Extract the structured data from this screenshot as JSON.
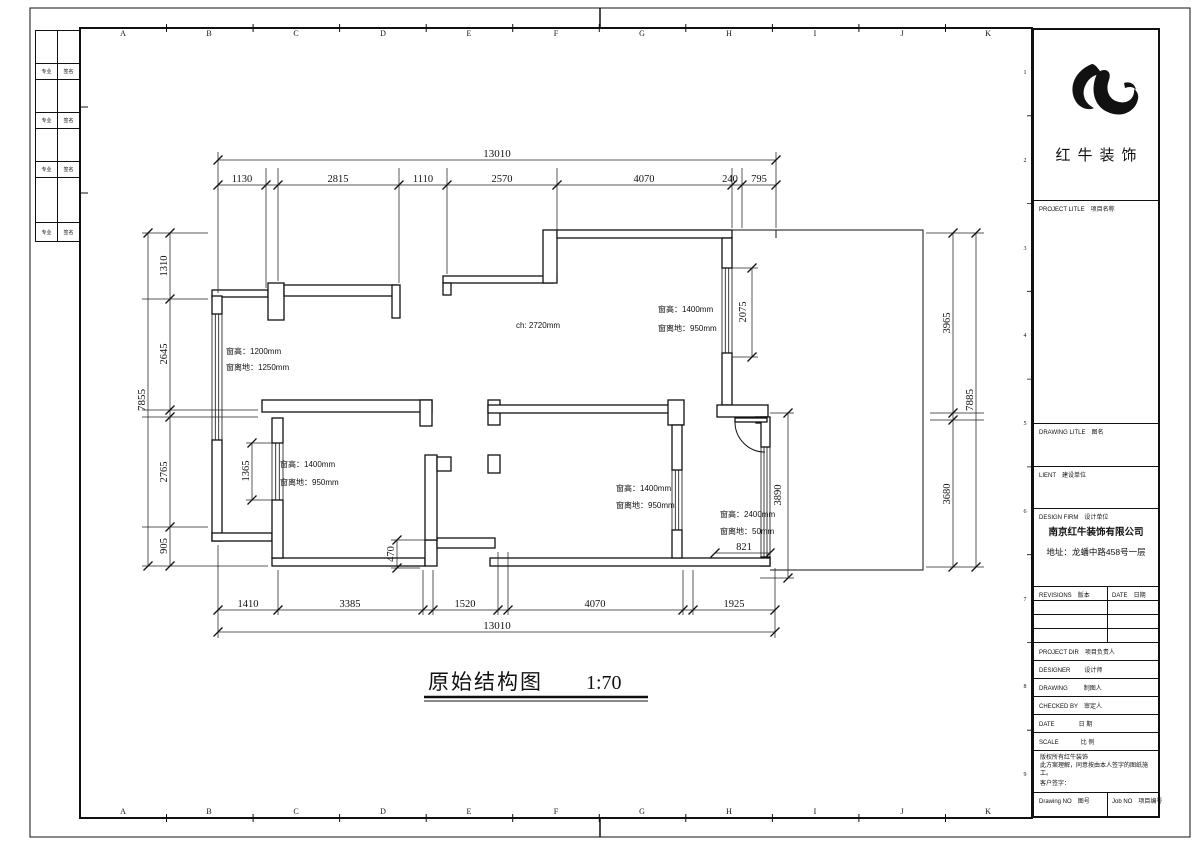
{
  "sheet": {
    "grid_letters": [
      "A",
      "B",
      "C",
      "D",
      "E",
      "F",
      "G",
      "H",
      "I",
      "J",
      "K"
    ],
    "grid_numbers": [
      "1",
      "2",
      "3",
      "4",
      "5",
      "6",
      "7",
      "8",
      "9"
    ],
    "signoff_rows": [
      {
        "c1": "专业",
        "c2": "签名"
      },
      {
        "c1": "专业",
        "c2": "签名"
      },
      {
        "c1": "专业",
        "c2": "签名"
      },
      {
        "c1": "专业",
        "c2": "签名"
      }
    ]
  },
  "plan": {
    "title": "原始结构图",
    "scale": "1:70",
    "dims": {
      "top": {
        "total": "13010",
        "segments": [
          "1130",
          "2815",
          "1110",
          "2570",
          "4070",
          "240",
          "795"
        ]
      },
      "bottom": {
        "total": "13010",
        "segments": [
          "1410",
          "3385",
          "1520",
          "4070",
          "1925"
        ]
      },
      "left": {
        "total": "7855",
        "segments": [
          "1310",
          "2645",
          "2765",
          "905"
        ]
      },
      "right": {
        "total": "7885",
        "segments": [
          "3965",
          "3680"
        ]
      },
      "inner": {
        "win_right_len": "2075",
        "win_left_len": "1365",
        "bath_height": "3890",
        "bath_width": "821",
        "step": "470"
      }
    },
    "annotations": {
      "ceiling": "ch: 2720mm",
      "win_left_upper": {
        "l1": "窗高：1200mm",
        "l2": "窗离地：1250mm"
      },
      "win_top_right": {
        "l1": "窗高：1400mm",
        "l2": "窗离地：950mm"
      },
      "win_left_lower": {
        "l1": "窗高：1400mm",
        "l2": "窗离地：950mm"
      },
      "win_center": {
        "l1": "窗高：1400mm",
        "l2": "窗离地：950mm"
      },
      "win_bath": {
        "l1": "窗高：2400mm",
        "l2": "窗离地：50mm"
      }
    }
  },
  "title_block": {
    "brand": "红牛装饰",
    "project_title": {
      "en": "PROJECT LITLE",
      "cn": "项目名称"
    },
    "drawing_title": {
      "en": "DRAWING LITLE",
      "cn": "图名"
    },
    "client": {
      "en": "LIENT",
      "cn": "建设单位"
    },
    "design_firm": {
      "en": "DESIGN FIRM",
      "cn": "设计单位"
    },
    "firm_name": "南京红牛装饰有限公司",
    "firm_address": "地址：龙蟠中路458号一层",
    "revisions": {
      "en": "REVISIONS",
      "cn": "版本"
    },
    "date_col": {
      "en": "DATE",
      "cn": "日期"
    },
    "project_dir": {
      "en": "PROJECT DIR",
      "cn": "项目负责人"
    },
    "designer": {
      "en": "DESIGNER",
      "cn": "设计师"
    },
    "drawing": {
      "en": "DRAWING",
      "cn": "制图人"
    },
    "checked_by": {
      "en": "CHECKED BY",
      "cn": "审定人"
    },
    "date_row": {
      "en": "DATE",
      "cn": "日 期"
    },
    "scale_row": {
      "en": "SCALE",
      "cn": "比 例"
    },
    "copyright_l1": "版权所有红牛装饰",
    "copyright_l2": "此方案理解，同意按由本人签字的图纸施工。",
    "customer_sign": "客户签字：",
    "drawing_no": {
      "en": "Drawing NO",
      "cn": "图号"
    },
    "job_no": {
      "en": "Job NO",
      "cn": "项目编号"
    }
  }
}
